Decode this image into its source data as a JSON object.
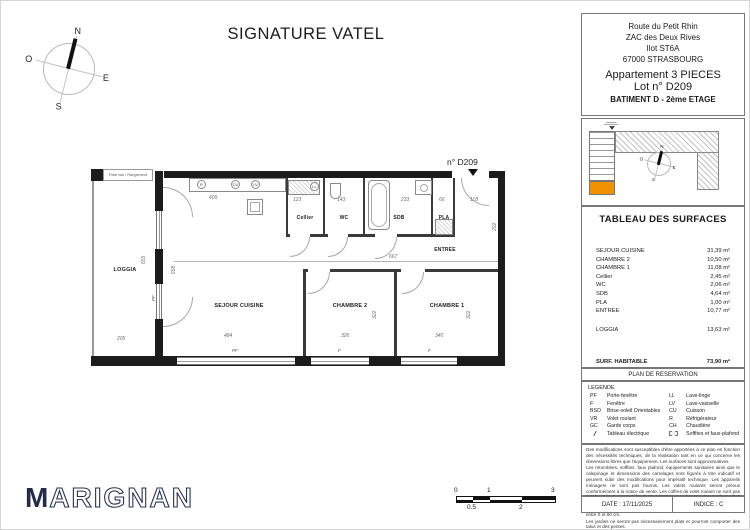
{
  "title": "SIGNATURE VATEL",
  "compass": {
    "n": "N",
    "e": "E",
    "s": "S",
    "o": "O"
  },
  "plan": {
    "tag": "n° D209",
    "pare_vue": "Pare vue / Rangement",
    "rooms": {
      "loggia": "LOGGIA",
      "sejour": "SEJOUR CUISINE",
      "chambre2": "CHAMBRE 2",
      "chambre1": "CHAMBRE 1",
      "cellier": "Cellier",
      "wc": "WC",
      "sdb": "SDB",
      "pla": "PLA",
      "entree": "ENTREE"
    },
    "appliances": {
      "r": "R",
      "cu": "CU",
      "lv": "LV",
      "ll": "LL"
    },
    "window_labels": {
      "pf": "PF",
      "f": "F"
    },
    "dims": [
      "409",
      "123",
      "143",
      "233",
      "66",
      "118",
      "202",
      "667",
      "484",
      "326",
      "340",
      "322",
      "322",
      "205",
      "655",
      "658"
    ]
  },
  "sidebar": {
    "address": [
      "Route du Petit Rhin",
      "ZAC des Deux Rives",
      "Ilot ST6A",
      "67000 STRASBOURG"
    ],
    "apartment": "Appartement 3 PIECES",
    "lot": "Lot n° D209",
    "building": "BATIMENT D - 2ème ETAGE",
    "surfaces": {
      "title": "TABLEAU DES SURFACES",
      "rows": [
        {
          "label": "SEJOUR CUISINE",
          "value": "31,39 m²"
        },
        {
          "label": "CHAMBRE 2",
          "value": "10,50 m²"
        },
        {
          "label": "CHAMBRE 1",
          "value": "11,08 m²"
        },
        {
          "label": "Cellier",
          "value": "2,45 m²"
        },
        {
          "label": "WC",
          "value": "2,06 m²"
        },
        {
          "label": "SDB",
          "value": "4,64 m²"
        },
        {
          "label": "PLA",
          "value": "1,00 m²"
        },
        {
          "label": "ENTREE",
          "value": "10,77 m²"
        }
      ],
      "loggia": {
        "label": "LOGGIA",
        "value": "13,63 m²"
      },
      "totals": [
        {
          "label": "SURF. HABITABLE",
          "value": "73,90 m²"
        },
        {
          "label": "SURF. TOTALE",
          "value": "87,53 m²"
        }
      ]
    },
    "reservation_title": "PLAN DE RESERVATION",
    "legend": {
      "title": "LEGENDE",
      "left": [
        {
          "abbr": "PF",
          "label": "Porte-fenêtre"
        },
        {
          "abbr": "F",
          "label": "Fenêtre"
        },
        {
          "abbr": "BSO",
          "label": "Brise-soleil Orientables"
        },
        {
          "abbr": "VR",
          "label": "Volet roulant"
        },
        {
          "abbr": "GC",
          "label": "Garde corps"
        },
        {
          "abbr": "",
          "label": "Tableau électrique"
        }
      ],
      "right": [
        {
          "abbr": "LL",
          "label": "Lave-linge"
        },
        {
          "abbr": "LV",
          "label": "Lave-vaisselle"
        },
        {
          "abbr": "CU",
          "label": "Cuisson"
        },
        {
          "abbr": "R",
          "label": "Réfrigérateur"
        },
        {
          "abbr": "CH",
          "label": "Chaudière"
        },
        {
          "abbr": "",
          "label": "Soffites et faux-plafond"
        }
      ]
    },
    "disclaimer": [
      "Des modifications sont susceptibles d'être apportées à ce plan en fonction des nécessités techniques, de la réalisation tant en ce qui concerne les dimensions libres que l'équipement. Les surfaces sont approximatives.",
      "Les retombées, soffites, faux plafond, équipements sanitaires ainsi que le calepinage et dimensions des carrelages sont figurés à titre indicatif et peuvent subir des modifications pour impératif technique. Les appareils ménagers ne sont pas fournis. Les volets roulants seront prévus conformément à la notice de vente. Les coffres de volet roulant ne sont pas représentés et seront débordants à l'intérieur. La hauteur des seuils au droit des porte-fenêtres sur balcons ou terrasses pourra varier de 5 à 35 cm à partir du sol intérieur. La hauteur entre le jardin et la terrasse pourra varier entre 0 et 60 cm.",
      "Les jardins ne seront pas nécessairement plats et pourront comporter des talus et des pentes."
    ],
    "date": "DATE : 17/11/2025",
    "indice": "INDICE : C"
  },
  "logo": {
    "initial": "M",
    "rest": "ARIGNAN"
  },
  "scalebar": {
    "labels_top": [
      "0",
      "1",
      "3"
    ],
    "labels_bottom": [
      "0.5",
      "2"
    ]
  },
  "colors": {
    "unit_highlight": "#f39200",
    "logo_navy": "#242c4e"
  }
}
